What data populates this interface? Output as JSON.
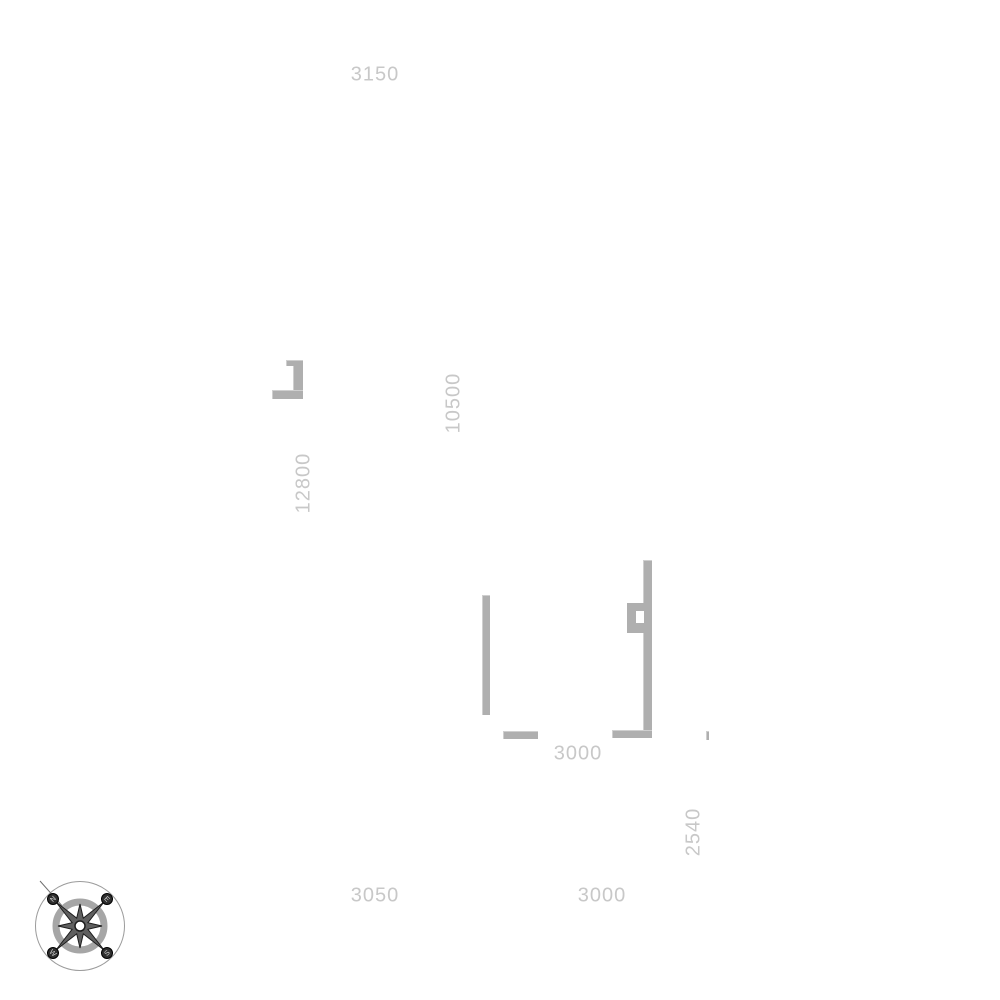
{
  "canvas": {
    "background": "#ffffff",
    "wall_color": "#afafaf",
    "label_color": "#c8c8c8"
  },
  "dimensions": {
    "top": "3150",
    "left_wall_height": "10500",
    "left_wall_length": "12800",
    "middle_width": "3000",
    "right_height": "2540",
    "bottom_left": "3050",
    "bottom_right": "3000"
  },
  "compass": {
    "north": "N",
    "east": "E",
    "south": "S",
    "west": "W"
  }
}
